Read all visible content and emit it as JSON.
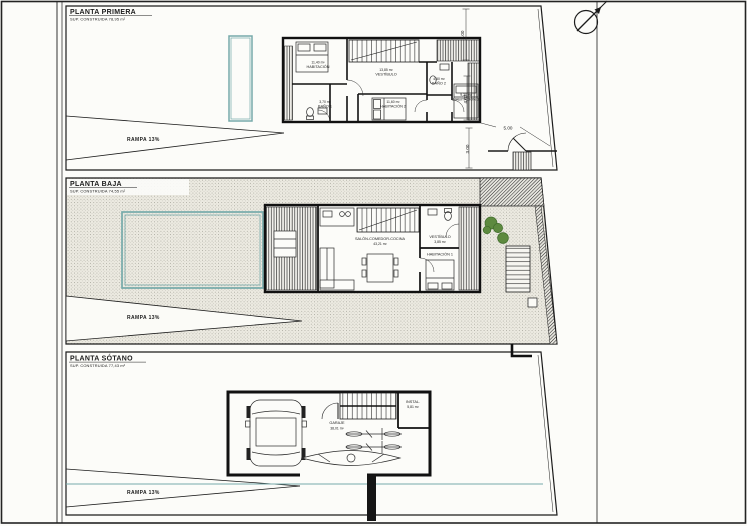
{
  "page": {
    "background": "#fcfcf9",
    "line_color": "#1c1c1c",
    "pool_color": "#76aaaa",
    "plant_color": "#4e7f35"
  },
  "compass": {
    "icon": "north-arrow"
  },
  "plans": [
    {
      "title": "PLANTA PRIMERA",
      "subtitle": "SUP. CONSTRUIDA 78,95 m²",
      "ramp_label": "RAMPA 13%",
      "rooms": {
        "habitacion": {
          "name": "HABITACIÓN",
          "area": "11,40 m²"
        },
        "bano1": {
          "name": "BAÑO 1",
          "area": "3,70 m²"
        },
        "vestibulo": {
          "name": "VESTÍBULO",
          "area": "13,85 m²"
        },
        "habitacion2": {
          "name": "HABITACIÓN 2",
          "area": "11,60 m²"
        },
        "bano2": {
          "name": "BAÑO 2",
          "area": "4,50 m²"
        },
        "habitacion3": {
          "name": "HABITACIÓN 3",
          "area": "9,20 m²"
        }
      },
      "dims": {
        "top": "3.00",
        "width": "5.00",
        "mid": "4.07",
        "low": "3.00"
      }
    },
    {
      "title": "PLANTA BAJA",
      "subtitle": "SUP. CONSTRUIDA 74,55 m²",
      "ramp_label": "RAMPA 13%",
      "rooms": {
        "salon": {
          "name": "SALÓN-COMEDOR-COCINA",
          "area": "43,21 m²"
        },
        "vestibulo": {
          "name": "VESTÍBULO",
          "area": "3,85 m²"
        },
        "habitacion1": {
          "name": "HABITACIÓN 1",
          "area": "10,30 m²"
        }
      }
    },
    {
      "title": "PLANTA SÓTANO",
      "subtitle": "SUP. CONSTRUIDA 77,43 m²",
      "ramp_label": "RAMPA 13%",
      "rooms": {
        "garaje": {
          "name": "GARAJE",
          "area": "38,01 m²"
        },
        "instalaciones": {
          "name": "INSTAL.",
          "area": "5,81 m²"
        }
      }
    }
  ]
}
